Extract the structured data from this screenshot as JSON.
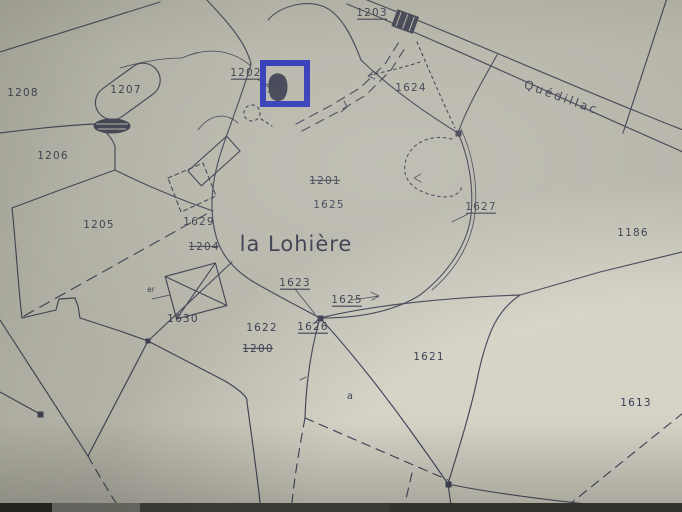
{
  "map": {
    "place_label": "la Lohière",
    "road_label": "Quédillac",
    "letter_label": "a",
    "small_label": "er",
    "parcel_labels": [
      {
        "text": "1208",
        "x": 23,
        "y": 96,
        "style": "plain"
      },
      {
        "text": "1207",
        "x": 126,
        "y": 93,
        "style": "plain"
      },
      {
        "text": "1206",
        "x": 53,
        "y": 159,
        "style": "plain"
      },
      {
        "text": "1205",
        "x": 99,
        "y": 228,
        "style": "plain"
      },
      {
        "text": "1203",
        "x": 372,
        "y": 16,
        "style": "underline"
      },
      {
        "text": "1202",
        "x": 246,
        "y": 76,
        "style": "underline"
      },
      {
        "text": "1624",
        "x": 411,
        "y": 91,
        "style": "plain"
      },
      {
        "text": "1201",
        "x": 325,
        "y": 184,
        "style": "strike"
      },
      {
        "text": "1625",
        "x": 329,
        "y": 208,
        "style": "plain"
      },
      {
        "text": "1627",
        "x": 481,
        "y": 210,
        "style": "underline"
      },
      {
        "text": "1186",
        "x": 633,
        "y": 236,
        "style": "plain"
      },
      {
        "text": "1629",
        "x": 199,
        "y": 225,
        "style": "plain"
      },
      {
        "text": "1204",
        "x": 204,
        "y": 250,
        "style": "strike"
      },
      {
        "text": "1623",
        "x": 295,
        "y": 286,
        "style": "underline"
      },
      {
        "text": "1625",
        "x": 347,
        "y": 303,
        "style": "underline"
      },
      {
        "text": "1626",
        "x": 313,
        "y": 330,
        "style": "underline"
      },
      {
        "text": "1622",
        "x": 262,
        "y": 331,
        "style": "plain"
      },
      {
        "text": "1200",
        "x": 258,
        "y": 352,
        "style": "strike"
      },
      {
        "text": "1630",
        "x": 183,
        "y": 322,
        "style": "plain"
      },
      {
        "text": "1621",
        "x": 429,
        "y": 360,
        "style": "plain"
      },
      {
        "text": "1613",
        "x": 636,
        "y": 406,
        "style": "plain"
      }
    ]
  },
  "highlight": {
    "color": "#2b35d6"
  },
  "colors": {
    "paper": "#d5d3c6",
    "ink": "#41435a"
  }
}
